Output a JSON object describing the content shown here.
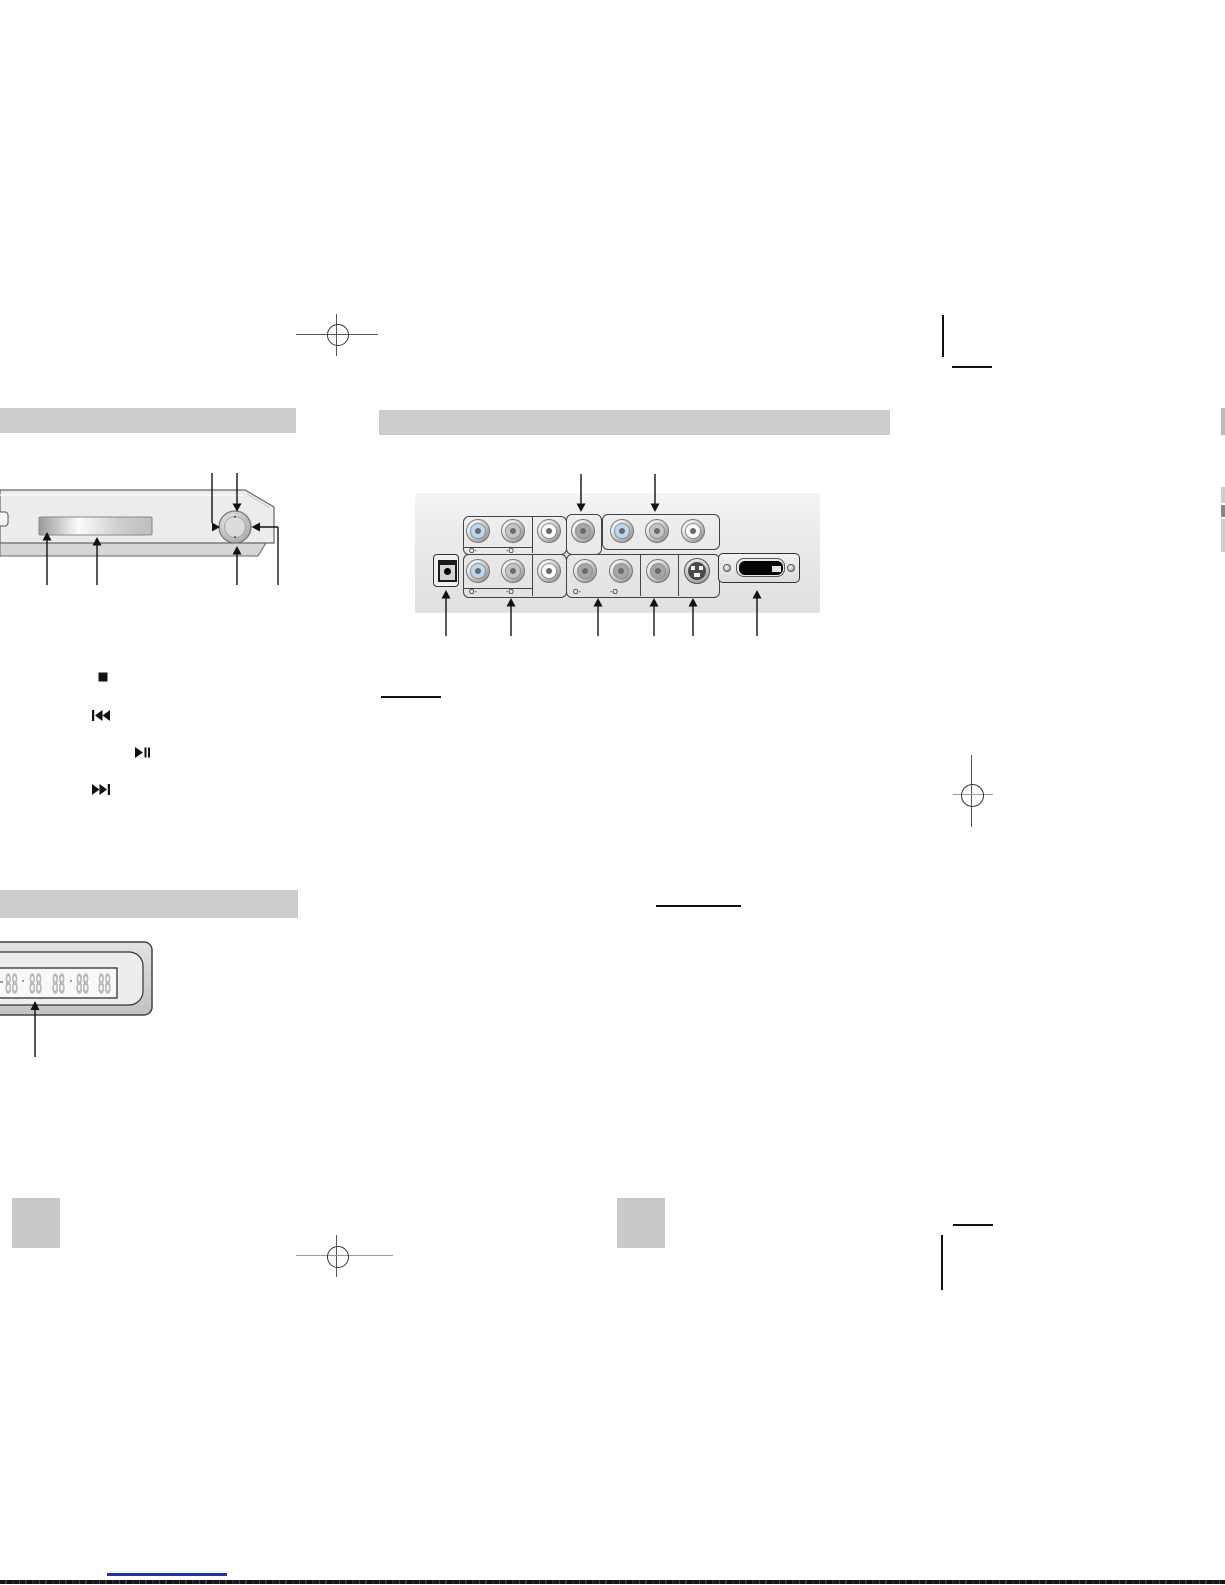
{
  "headers": {
    "front_panel_label": "",
    "rear_panel_label": "",
    "front_display_label": ""
  },
  "playback_controls": [
    {
      "name": "stop"
    },
    {
      "name": "skip-back"
    },
    {
      "name": "play-pause"
    },
    {
      "name": "skip-forward"
    }
  ],
  "front_display": {
    "digit_groups": [
      "88",
      "88",
      "88",
      "88",
      "88"
    ]
  },
  "rear_panel": {
    "top_jacks": [
      "blue",
      "gray",
      "white",
      "dark",
      "blue",
      "gray",
      "white"
    ],
    "bottom_jacks": [
      "blue",
      "gray",
      "white",
      "dark",
      "dark",
      "dark"
    ],
    "channel_marks": {
      "left": "O-",
      "right": "-O"
    }
  },
  "colors": {
    "header_bar": "#cccccc",
    "player_body": "#ececec",
    "rear_panel_bg": "#ececec",
    "jack_blue": "#b7d9f2",
    "jack_gray": "#c4c4c4",
    "jack_white": "#fbfbfb",
    "jack_dark": "#a6a6a6",
    "underline_blue": "#2230be"
  }
}
